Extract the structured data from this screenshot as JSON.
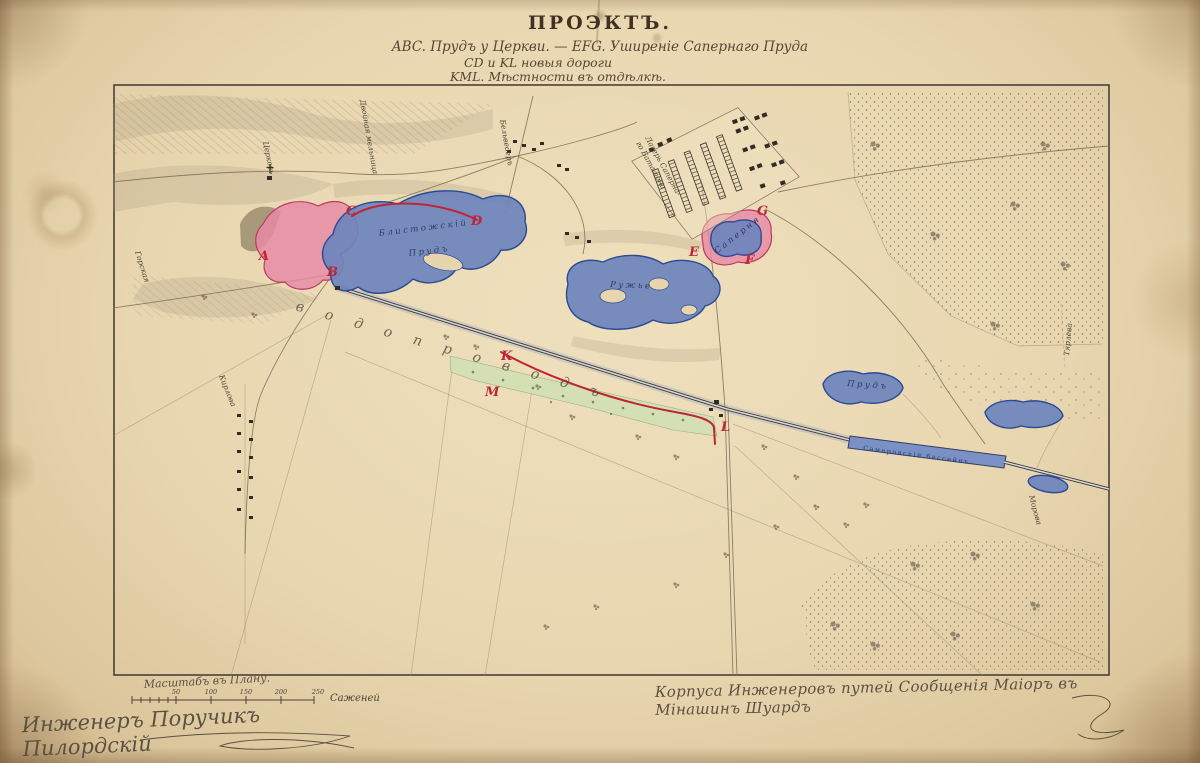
{
  "title": {
    "main": "ПРОЭКТЪ.",
    "sub1": "ABC. Прудъ у Церкви. — EFG. Уширеніе Сапернаго Пруда",
    "sub2": "CD и KL новыя дороги",
    "sub3": "KML. Мѣстности въ отдѣлкѣ."
  },
  "map": {
    "markers": [
      "A",
      "B",
      "C",
      "D",
      "E",
      "F",
      "G",
      "K",
      "M",
      "L"
    ],
    "labels": {
      "pond1a": "Блистожскій",
      "pond1b": "Прудъ",
      "pond2": "Ружье",
      "saperny_pond": "Саперня",
      "camp1": "Лагерь Саперна-",
      "camp2": "го Баталіона",
      "church": "Церковь",
      "belvedere": "Бельведеръ",
      "mill": "Двойная мельница",
      "aqueduct": "водопроводъ",
      "basin": "Самеровскій бассейнъ",
      "pond_small": "Прудъ",
      "tyarleva": "Тярлева",
      "gorskaya": "Горская",
      "kirlova": "Кирлова",
      "morova": "Морова"
    }
  },
  "scale": {
    "caption": "Масштабъ въ Плану.",
    "ticks": [
      "50",
      "100",
      "150",
      "200",
      "250"
    ],
    "unit": "Саженей"
  },
  "signatures": {
    "left": "Инженеръ Поручикъ Пилордскій",
    "right": "Корпуса Инженеровъ путей Сообщенія Маіоръ въ Мінашинъ Шуардъ"
  },
  "colors": {
    "pond_fill": "#6d84bd",
    "pond_stroke": "#2b4a94",
    "pink_fill": "#e789a5",
    "red": "#c02536",
    "green": "#cfe0b2",
    "paper": "#e7d5ae",
    "ink": "#4a3f2e"
  }
}
